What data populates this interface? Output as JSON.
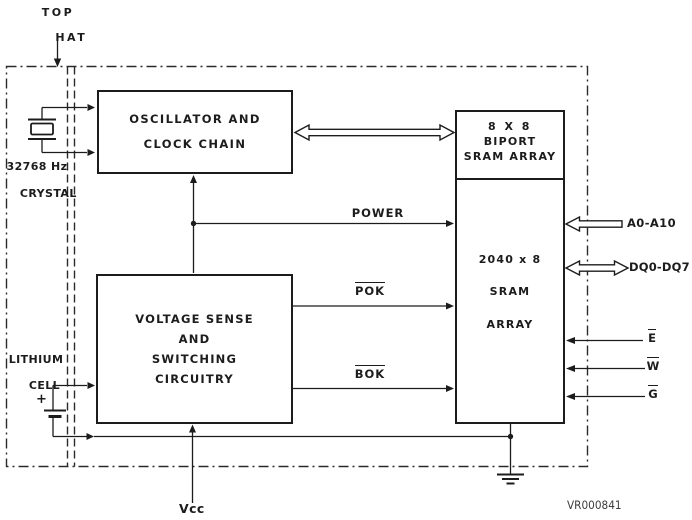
{
  "figure": {
    "id": "VR000841"
  },
  "package": {
    "top_hat": {
      "line1": "TOP",
      "line2": "HAT"
    }
  },
  "crystal": {
    "freq": "32768 Hz",
    "name": "CRYSTAL"
  },
  "battery": {
    "name_line1": "LITHIUM",
    "name_line2": "CELL",
    "polarity": "+"
  },
  "blocks": {
    "oscillator": {
      "line1": "OSCILLATOR AND",
      "line2": "CLOCK CHAIN"
    },
    "biport": {
      "line1": "8 X 8",
      "line2": "BIPORT",
      "line3": "SRAM ARRAY"
    },
    "sram": {
      "line1": "2040 x 8",
      "line2": "SRAM",
      "line3": "ARRAY"
    },
    "voltage": {
      "line1": "VOLTAGE SENSE",
      "line2": "AND",
      "line3": "SWITCHING",
      "line4": "CIRCUITRY"
    }
  },
  "signals": {
    "power": "POWER",
    "pok": "POK",
    "bok": "BOK",
    "address_bus": "A0-A10",
    "data_bus": "DQ0-DQ7",
    "chip_enable": "E",
    "write_enable": "W",
    "output_enable": "G",
    "vcc": "Vcc"
  },
  "colors": {
    "ink": "#1c1c1c",
    "background": "#ffffff"
  }
}
